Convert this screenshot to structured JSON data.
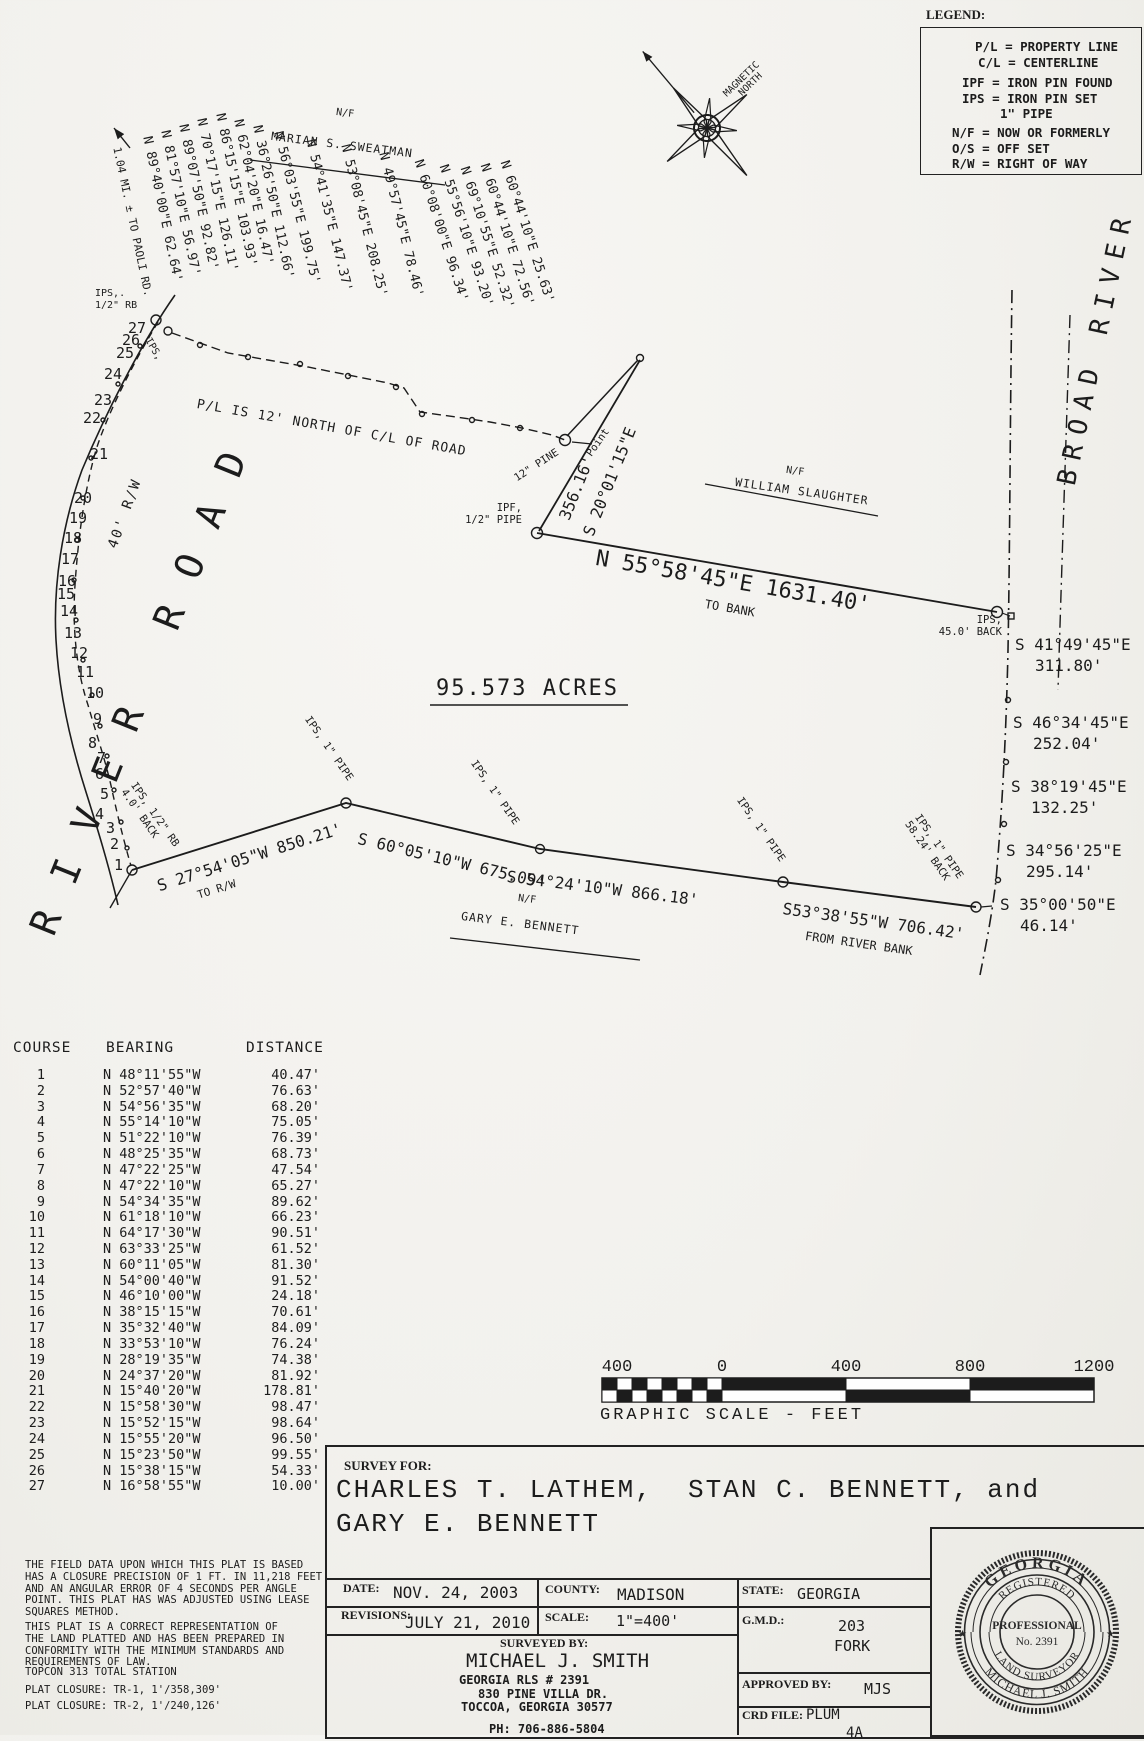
{
  "legend": {
    "title": "LEGEND:",
    "items": [
      "P/L = PROPERTY LINE",
      "C/L = CENTERLINE",
      "IPF = IRON PIN FOUND",
      "IPS = IRON PIN SET",
      "1\" PIPE",
      "N/F = NOW OR FORMERLY",
      "O/S = OFF SET",
      "R/W = RIGHT OF WAY"
    ]
  },
  "compass": {
    "label": "MAGNETIC\n  NORTH"
  },
  "plat": {
    "acreage": "95.573 ACRES",
    "road_label": "RIVER ROAD",
    "river_label": "BROAD RIVER",
    "row_width": "40' R/W",
    "paoli_note": "1.04 MI. ± TO PAOLI RD.",
    "pl_note": "P/L IS 12' NORTH OF C/L OF ROAD",
    "nf": "N/F",
    "adjoiner_sweatman": "MARIAN S. SWEATMAN",
    "adjoiner_slaughter": "WILLIAM SLAUGHTER",
    "adjoiner_bennett": "GARY E. BENNETT",
    "fan_bearings": [
      "N 89°40'00\"E 62.64'",
      "N 81°57'10\"E 56.97'",
      "N 89°07'50\"E 92.82'",
      "N 70°17'15\"E 126.11'",
      "N 86°15'15\"E 103.93'",
      "N 62°04'20\"E 16.47'",
      "N 36°26'50\"E 112.66'",
      "N 56°03'55\"E 199.75'",
      "N 54°41'35\"E 147.37'",
      "N 53°08'45\"E 208.25'",
      "N 49°57'45\"E 78.46'",
      "N 60°08'00\"E 96.34'",
      "N 55°56'10\"E 93.20'",
      "N 69°10'55\"E 52.32'",
      "N 60°44'10\"E 72.56'",
      "N 60°44'10\"E 25.63'"
    ],
    "course_numbers": [
      "1",
      "2",
      "3",
      "4",
      "5",
      "6",
      "7",
      "8",
      "9",
      "10",
      "11",
      "12",
      "13",
      "14",
      "15",
      "16",
      "17",
      "18",
      "19",
      "20",
      "21",
      "22",
      "23",
      "24",
      "25",
      "26",
      "27"
    ],
    "ips_rb_top": "IPS,.\n1/2\" RB",
    "ips_diag": "IPS,",
    "pine": "12\" PINE",
    "point": "Point",
    "dist_356": "356.16'",
    "brg_s20": "S 20°01'15\"E",
    "ipf_label": "IPF,\n1/2\" PIPE",
    "long_line_label": "N 55°58'45\"E 1631.40'",
    "to_bank": "TO BANK",
    "ips_back": "IPS,\n45.0' BACK",
    "river_courses": [
      {
        "bearing": "S 41°49'45\"E",
        "distance": "311.80'"
      },
      {
        "bearing": "S 46°34'45\"E",
        "distance": "252.04'"
      },
      {
        "bearing": "S 38°19'45\"E",
        "distance": "132.25'"
      },
      {
        "bearing": "S 34°56'25\"E",
        "distance": "295.14'"
      },
      {
        "bearing": "S 35°00'50\"E",
        "distance": "46.14'"
      }
    ],
    "brg_850": "S 27°54'05\"W 850.21'",
    "to_rw": "TO R/W",
    "brg_675": "S 60°05'10\"W 675.09'",
    "brg_866": "S 54°24'10\"W 866.18'",
    "brg_706": "S53°38'55\"W 706.42'",
    "from_river_bank": "FROM RIVER BANK",
    "ips_pipe": "IPS, 1\" PIPE",
    "ips_5824": "IPS, 1\" PIPE\n58.24' BACK",
    "ips_rb_40": "IPS, 1/2\" RB\n4.0' BACK"
  },
  "course_table": {
    "headers": [
      "COURSE",
      "BEARING",
      "DISTANCE"
    ],
    "rows": [
      [
        "1",
        "N 48°11'55\"W",
        "40.47'"
      ],
      [
        "2",
        "N 52°57'40\"W",
        "76.63'"
      ],
      [
        "3",
        "N 54°56'35\"W",
        "68.20'"
      ],
      [
        "4",
        "N 55°14'10\"W",
        "75.05'"
      ],
      [
        "5",
        "N 51°22'10\"W",
        "76.39'"
      ],
      [
        "6",
        "N 48°25'35\"W",
        "68.73'"
      ],
      [
        "7",
        "N 47°22'25\"W",
        "47.54'"
      ],
      [
        "8",
        "N 47°22'10\"W",
        "65.27'"
      ],
      [
        "9",
        "N 54°34'35\"W",
        "89.62'"
      ],
      [
        "10",
        "N 61°18'10\"W",
        "66.23'"
      ],
      [
        "11",
        "N 64°17'30\"W",
        "90.51'"
      ],
      [
        "12",
        "N 63°33'25\"W",
        "61.52'"
      ],
      [
        "13",
        "N 60°11'05\"W",
        "81.30'"
      ],
      [
        "14",
        "N 54°00'40\"W",
        "91.52'"
      ],
      [
        "15",
        "N 46°10'00\"W",
        "24.18'"
      ],
      [
        "16",
        "N 38°15'15\"W",
        "70.61'"
      ],
      [
        "17",
        "N 35°32'40\"W",
        "84.09'"
      ],
      [
        "18",
        "N 33°53'10\"W",
        "76.24'"
      ],
      [
        "19",
        "N 28°19'35\"W",
        "74.38'"
      ],
      [
        "20",
        "N 24°37'20\"W",
        "81.92'"
      ],
      [
        "21",
        "N 15°40'20\"W",
        "178.81'"
      ],
      [
        "22",
        "N 15°58'30\"W",
        "98.47'"
      ],
      [
        "23",
        "N 15°52'15\"W",
        "98.64'"
      ],
      [
        "24",
        "N 15°55'20\"W",
        "96.50'"
      ],
      [
        "25",
        "N 15°23'50\"W",
        "99.55'"
      ],
      [
        "26",
        "N 15°38'15\"W",
        "54.33'"
      ],
      [
        "27",
        "N 16°58'55\"W",
        "10.00'"
      ]
    ]
  },
  "notes": {
    "p1": "THE FIELD DATA UPON WHICH THIS PLAT IS BASED\nHAS A CLOSURE PRECISION OF 1 FT. IN 11,218 FEET\nAND AN ANGULAR ERROR OF 4 SECONDS PER ANGLE\nPOINT. THIS PLAT HAS WAS ADJUSTED USING LEASE\nSQUARES METHOD.",
    "p2": "THIS PLAT IS A CORRECT REPRESENTATION OF\nTHE LAND PLATTED AND HAS BEEN PREPARED IN\nCONFORMITY WITH THE MINIMUM STANDARDS AND\nREQUIREMENTS OF LAW.",
    "p3": "TOPCON 313 TOTAL STATION",
    "p4": "PLAT CLOSURE: TR-1, 1'/358,309'",
    "p5": "PLAT CLOSURE: TR-2, 1'/240,126'"
  },
  "scale_bar": {
    "labels": [
      "400",
      "0",
      "400",
      "800",
      "1200"
    ],
    "caption": "GRAPHIC SCALE - FEET"
  },
  "title_block": {
    "survey_for_label": "SURVEY FOR:",
    "client_line1": "CHARLES T. LATHEM,  STAN C. BENNETT, and",
    "client_line2": "GARY E. BENNETT",
    "date_label": "DATE:",
    "date": "NOV. 24, 2003",
    "county_label": "COUNTY:",
    "county": "MADISON",
    "state_label": "STATE:",
    "state": "GEORGIA",
    "revisions_label": "REVISIONS:",
    "revisions": "JULY 21, 2010",
    "scale_label": "SCALE:",
    "scale": "1\"=400'",
    "gmd_label": "G.M.D.:",
    "gmd_value": "203",
    "gmd_value2": "FORK",
    "surveyed_by_label": "SURVEYED BY:",
    "surveyor": "MICHAEL J. SMITH",
    "surveyor_line2": "GEORGIA RLS # 2391",
    "surveyor_line3": "830 PINE VILLA DR.",
    "surveyor_line4": "TOCCOA, GEORGIA 30577",
    "surveyor_line5": "PH: 706-886-5804",
    "approved_label": "APPROVED BY:",
    "approved": "MJS",
    "crd_label": "CRD FILE:",
    "crd_value": "PLUM",
    "crd_value2": "4A"
  },
  "seal": {
    "state": "GEORGIA",
    "registered": "REGISTERED",
    "professional": "PROFESSIONAL",
    "number": "No. 2391",
    "surveyor_type": "LAND SURVEYOR",
    "name": "MICHAEL J. SMITH",
    "star_left": "★",
    "star_right": "★"
  }
}
